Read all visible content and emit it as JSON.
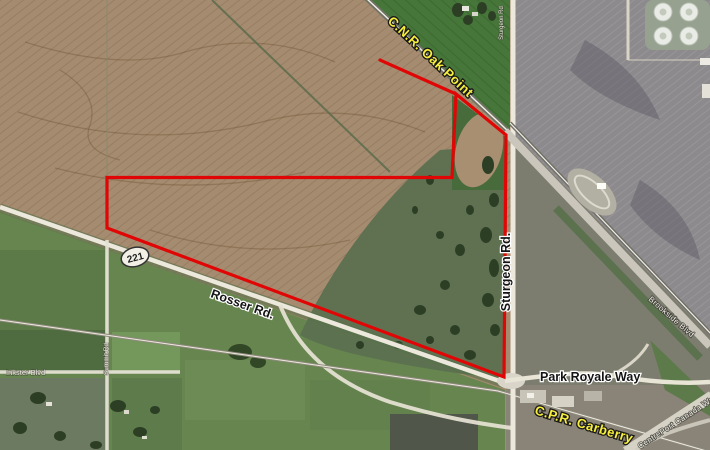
{
  "map": {
    "type": "satellite-aerial-with-parcel-overlay",
    "labels": {
      "cnr": "C.N.R. Oak Point",
      "cpr": "C.P.R. Carberry",
      "sturgeon": "Sturgeon Rd.",
      "sturgeon_small": "Sturgeon Rd",
      "rosser": "Rosser Rd.",
      "park_royale": "Park Royale Way",
      "inkster": "Inkster Blvd",
      "summit": "Summit Rd",
      "brookside": "Brookside Blvd",
      "centreport": "CentrePort Canada Way",
      "route_shield": "221"
    },
    "colors": {
      "boundary_red": "#e00605",
      "railway_label_yellow": "#f7ef3c",
      "road_label_black": "#141414",
      "label_halo_white": "#ffffff",
      "farmland_brown": "#a58b6f",
      "field_green": "#67854e",
      "field_grey": "#8d8a8d"
    }
  }
}
